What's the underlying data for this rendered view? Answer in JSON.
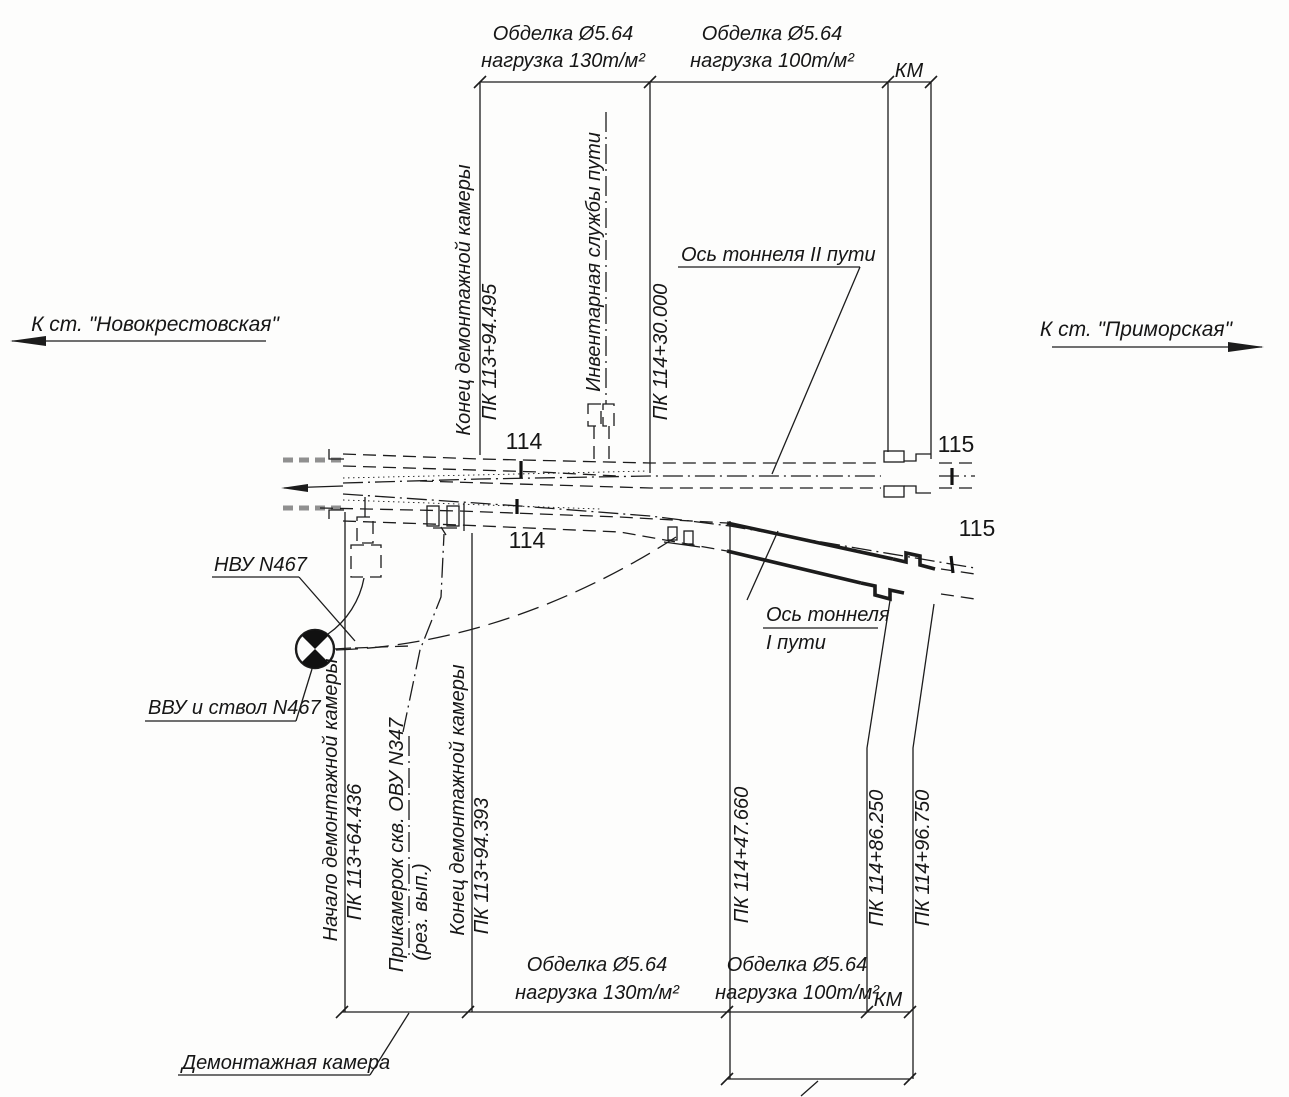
{
  "stations": {
    "left": "К ст. \"Новокрестовская\"",
    "right": "К ст. \"Приморская\""
  },
  "dim_top": {
    "seg1": {
      "l1": "Обделка Ø5.64",
      "l2": "нагрузка 130т/м²"
    },
    "seg2": {
      "l1": "Обделка Ø5.64",
      "l2": "нагрузка 100т/м²"
    },
    "km": "КМ"
  },
  "dim_bottom": {
    "seg1": {
      "l1": "Обделка Ø5.64",
      "l2": "нагрузка 130т/м²"
    },
    "seg2": {
      "l1": "Обделка Ø5.64",
      "l2": "нагрузка 100т/м²"
    },
    "km": "КМ"
  },
  "axis_labels": {
    "track2": "Ось тоннеля II пути",
    "track1_l1": "Ось тоннеля",
    "track1_l2": "I пути"
  },
  "callouts": {
    "nvu": "НВУ N467",
    "vvu": "ВВУ и ствол N467",
    "chamber": "Демонтажная камера",
    "inventory": "Инвентарная службы пути",
    "prikamerok_l1": "Прикамерок скв. ОВУ N347",
    "prikamerok_l2": "(рез. вып.)"
  },
  "stationing": {
    "end_chamber_top": {
      "label": "Конец демонтажной камеры",
      "pk": "ПК 113+94.495"
    },
    "pk114_30": "ПК 114+30.000",
    "start_chamber": {
      "label": "Начало демонтажной камеры",
      "pk": "ПК 113+64.436"
    },
    "end_chamber_bottom": {
      "label": "Конец демонтажной камеры",
      "pk": "ПК 113+94.393"
    },
    "pk114_47": "ПК 114+47.660",
    "pk114_86": "ПК 114+86.250",
    "pk114_96": "ПК 114+96.750"
  },
  "pickets": {
    "p114": "114",
    "p115": "115"
  }
}
